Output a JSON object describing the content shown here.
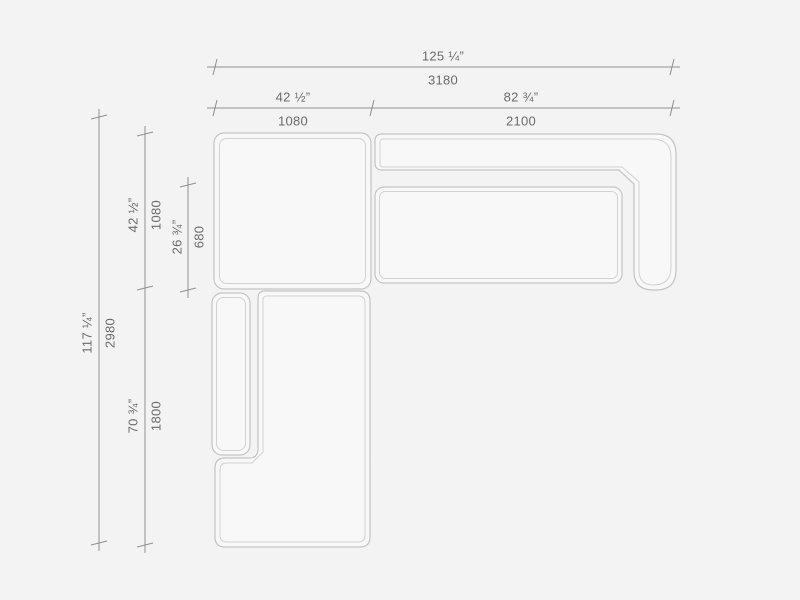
{
  "colors": {
    "background": "#f3f3f3",
    "piece-fill": "#f8f8f8",
    "outline-outer": "#c4c4c4",
    "outline-inner": "#d2d2d2",
    "dim-line": "#909090",
    "dim-text": "#6b6b6b"
  },
  "dimensions": {
    "top": [
      {
        "name": "overall-width",
        "inches": "125 ¼”",
        "mm": "3180"
      },
      {
        "name": "corner-section-width",
        "inches": "42 ½”",
        "mm": "1080"
      },
      {
        "name": "sofa-section-width",
        "inches": "82 ¾”",
        "mm": "2100"
      }
    ],
    "left": [
      {
        "name": "overall-depth",
        "inches": "117 ¼”",
        "mm": "2980"
      },
      {
        "name": "corner-section-depth",
        "inches": "42 ½”",
        "mm": "1080"
      },
      {
        "name": "seat-depth",
        "inches": "26 ¾”",
        "mm": "680"
      },
      {
        "name": "chaise-section-length",
        "inches": "70 ¾”",
        "mm": "1800"
      }
    ]
  }
}
